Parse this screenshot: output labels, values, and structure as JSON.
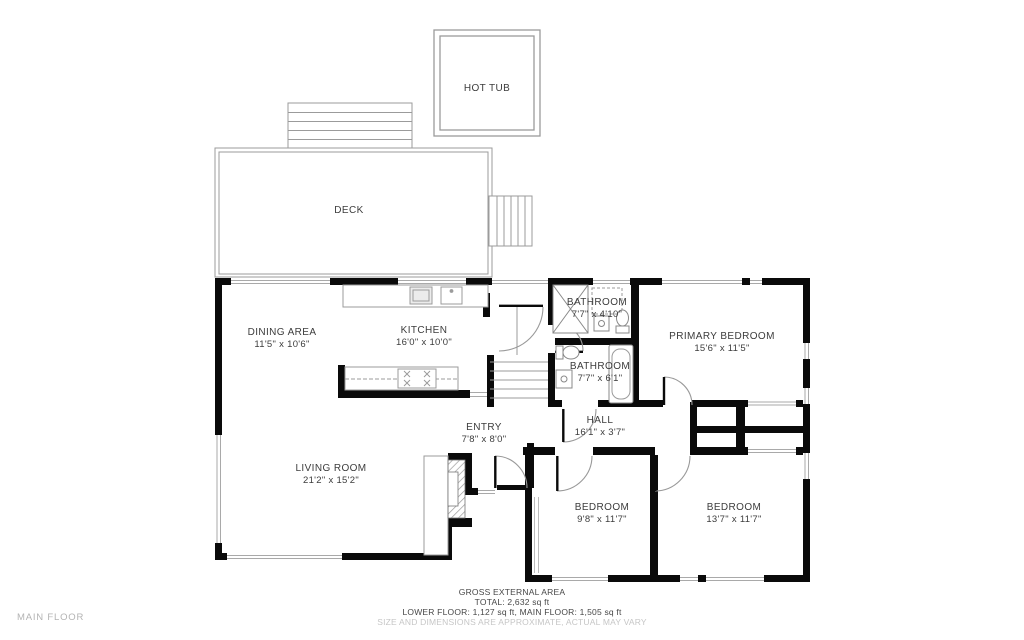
{
  "floor_label": "MAIN FLOOR",
  "rooms": {
    "hot_tub": {
      "name": "HOT TUB",
      "dims": ""
    },
    "deck": {
      "name": "DECK",
      "dims": ""
    },
    "dining": {
      "name": "DINING AREA",
      "dims": "11'5\" x 10'6\""
    },
    "kitchen": {
      "name": "KITCHEN",
      "dims": "16'0\" x 10'0\""
    },
    "bathroom_upper": {
      "name": "BATHROOM",
      "dims": "7'7\" x 4'10\""
    },
    "bathroom_lower": {
      "name": "BATHROOM",
      "dims": "7'7\" x 6'1\""
    },
    "primary_bedroom": {
      "name": "PRIMARY BEDROOM",
      "dims": "15'6\" x 11'5\""
    },
    "entry": {
      "name": "ENTRY",
      "dims": "7'8\" x 8'0\""
    },
    "hall": {
      "name": "HALL",
      "dims": "16'1\" x 3'7\""
    },
    "living_room": {
      "name": "LIVING ROOM",
      "dims": "21'2\" x 15'2\""
    },
    "bedroom_left": {
      "name": "BEDROOM",
      "dims": "9'8\" x 11'7\""
    },
    "bedroom_right": {
      "name": "BEDROOM",
      "dims": "13'7\" x 11'7\""
    }
  },
  "footer": {
    "title": "GROSS EXTERNAL AREA",
    "total": "TOTAL: 2,632 sq ft",
    "floors": "LOWER FLOOR: 1,127 sq ft, MAIN FLOOR: 1,505 sq ft",
    "disclaimer": "SIZE AND DIMENSIONS ARE APPROXIMATE, ACTUAL MAY VARY"
  },
  "colors": {
    "wall": "#0a0a0a",
    "thin_line": "#9b9b9b",
    "text": "#3c3c3c",
    "muted": "#c6c6c6",
    "floor_label": "#b3b3b3"
  }
}
